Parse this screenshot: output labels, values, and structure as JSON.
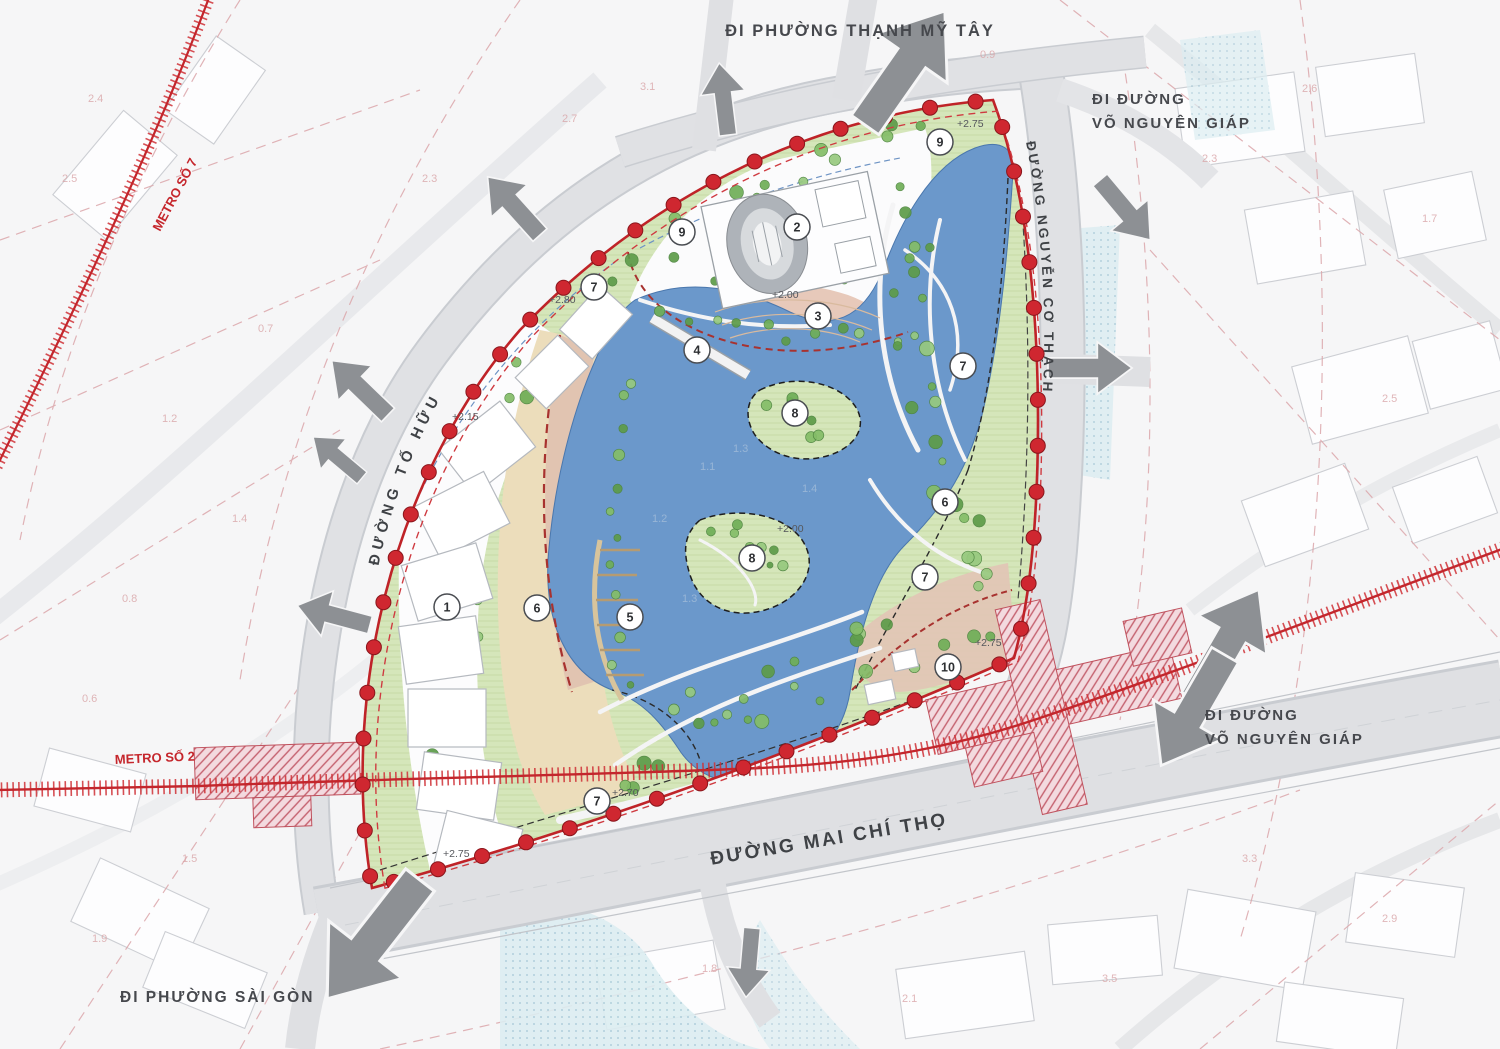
{
  "map": {
    "road_labels": {
      "to_huu": "ĐƯỜNG TỐ HỮU",
      "nguyen_co_thach": "ĐƯỜNG NGUYỄN CƠ THẠCH",
      "mai_chi_tho": "ĐƯỜNG MAI CHÍ THỌ"
    },
    "direction_labels": {
      "thanh_my_tay": "ĐI PHƯỜNG THẠNH MỸ TÂY",
      "vo_nguyen_giap_top_1": "ĐI ĐƯỜNG",
      "vo_nguyen_giap_top_2": "VÕ NGUYÊN GIÁP",
      "vo_nguyen_giap_right_1": "ĐI ĐƯỜNG",
      "vo_nguyen_giap_right_2": "VÕ NGUYÊN GIÁP",
      "sai_gon": "ĐI PHƯỜNG SÀI GÒN"
    },
    "metro_labels": {
      "metro_7": "METRO SỐ 7",
      "metro_2": "METRO SỐ 2"
    },
    "zone_markers": [
      {
        "label": "9"
      },
      {
        "label": "2"
      },
      {
        "label": "3"
      },
      {
        "label": "4"
      },
      {
        "label": "7"
      },
      {
        "label": "9"
      },
      {
        "label": "7"
      },
      {
        "label": "8"
      },
      {
        "label": "6"
      },
      {
        "label": "8"
      },
      {
        "label": "7"
      },
      {
        "label": "1"
      },
      {
        "label": "6"
      },
      {
        "label": "5"
      },
      {
        "label": "10"
      },
      {
        "label": "7"
      }
    ],
    "elevation_labels": [
      "+2.75",
      "+2.80",
      "+2.00",
      "+2.15",
      "+2.00",
      "+2.75",
      "+2.70",
      "+2.75"
    ],
    "background_numbers": [
      "2.4",
      "2.5",
      "0.7",
      "1.2",
      "1.4",
      "0.8",
      "0.6",
      "1.5",
      "1.9",
      "2.3",
      "2.7",
      "3.1",
      "0.9",
      "2.3",
      "2.6",
      "1.7",
      "2.5",
      "3.3",
      "2.9",
      "3.5",
      "2.1",
      "1.8"
    ],
    "lake_numbers": [
      "1.1",
      "1.3",
      "1.2",
      "1.4",
      "1.3"
    ],
    "colors": {
      "boundary_red": "#bf2328",
      "metro_red": "#cf3036",
      "lake_blue": "#6b98cb",
      "park_green": "#d5e6ba",
      "tree_green": "#6fae57",
      "sand_tan": "#ecddbb",
      "path_pink": "#e7c9ba",
      "road_gray": "#e0e1e4",
      "arrow_gray": "#8d9094",
      "station_pink": "#f3dadf"
    }
  }
}
